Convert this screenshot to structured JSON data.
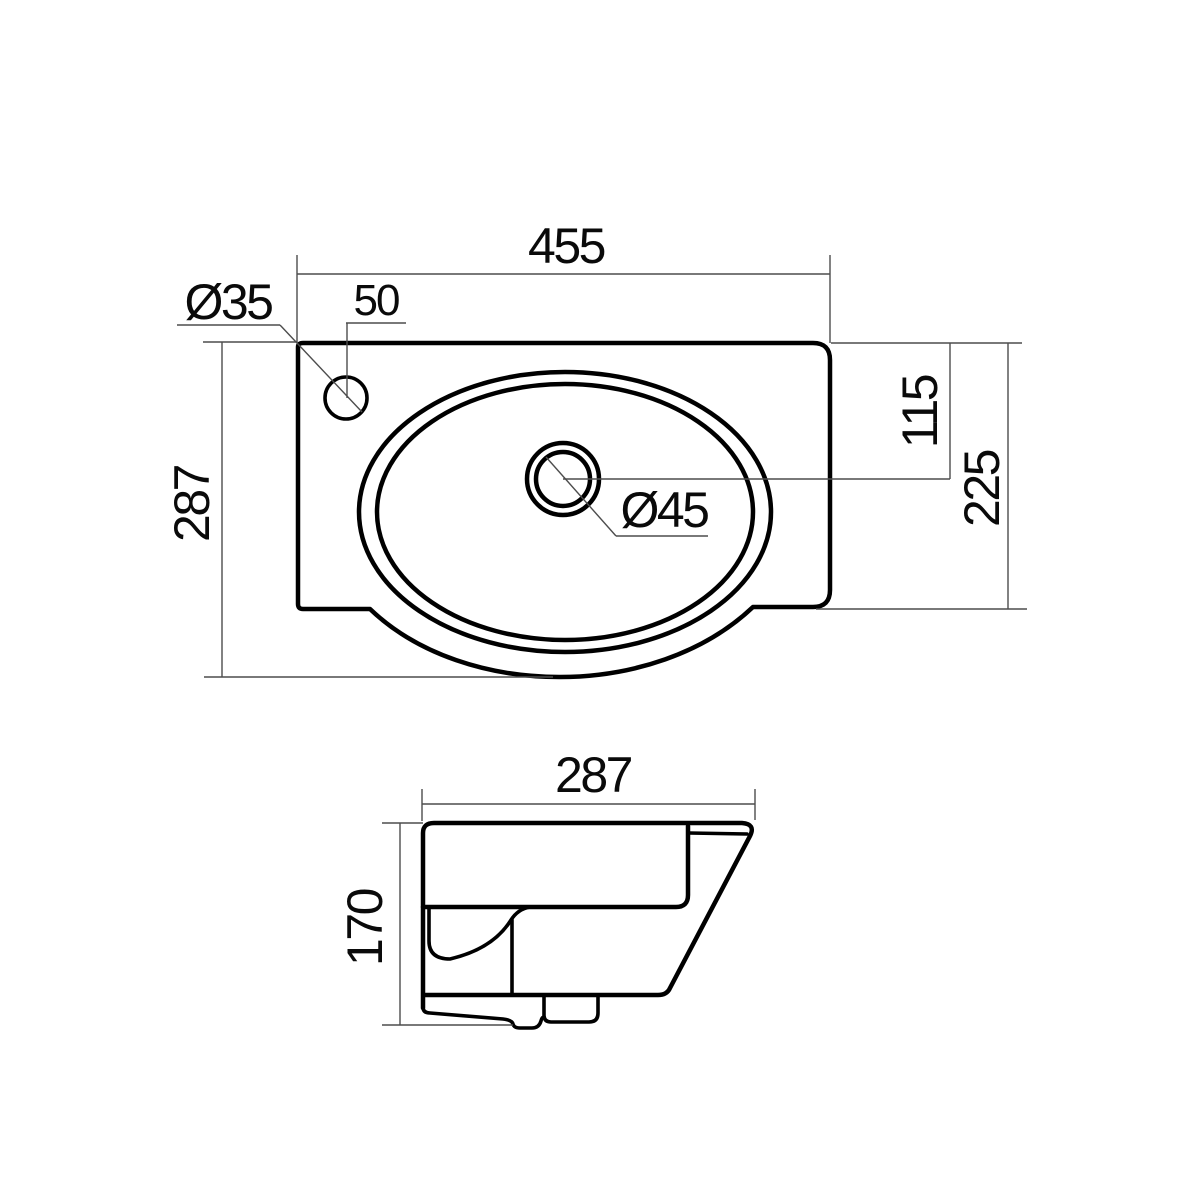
{
  "drawing": {
    "title": "Wall-hung washbasin dimensional drawing",
    "colors": {
      "background": "#ffffff",
      "object_line": "#000000",
      "dimension_line": "#4d4d4d",
      "text": "#0a0a0a"
    },
    "top_view": {
      "overall_width": "455",
      "overall_depth": "287",
      "faucet_hole_diameter": "Ø35",
      "faucet_hole_offset": "50",
      "drain_diameter": "Ø45",
      "drain_center_from_back": "115",
      "body_depth_right": "225"
    },
    "side_view": {
      "depth": "287",
      "height": "170"
    }
  }
}
